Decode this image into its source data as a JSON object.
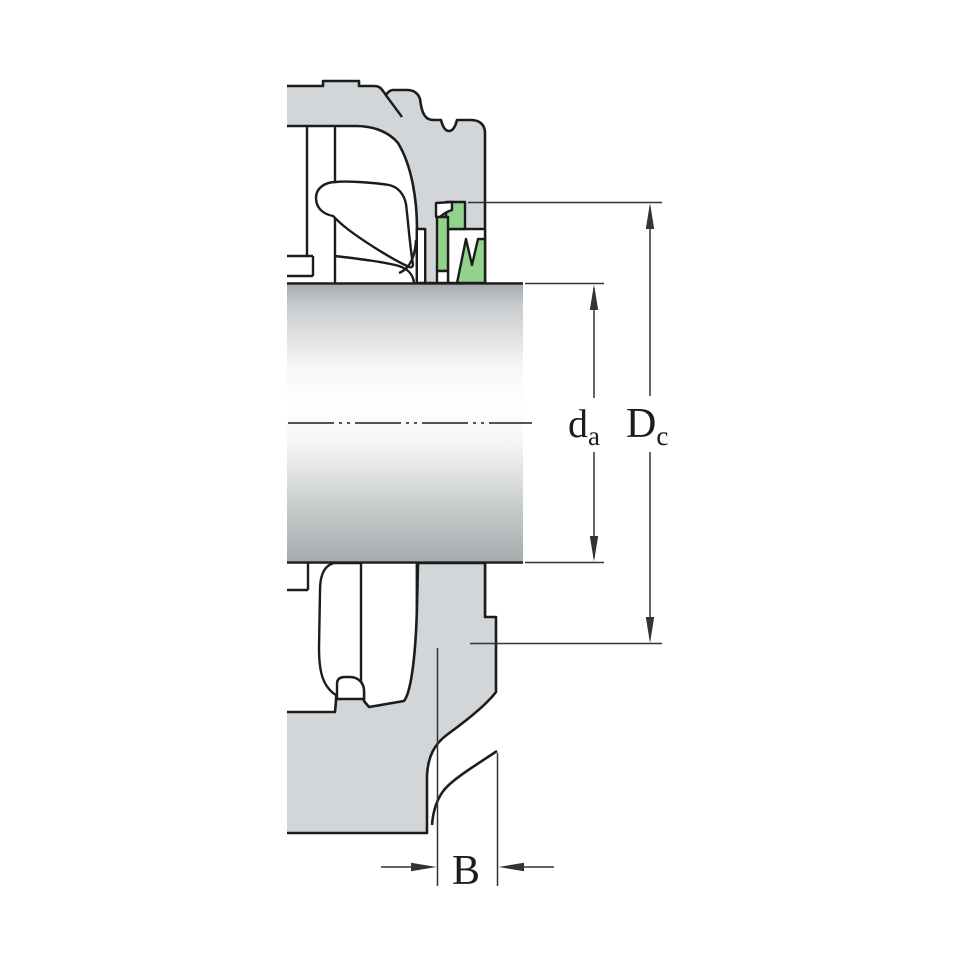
{
  "figure": {
    "kind": "bearing-unit cross-section technical drawing"
  },
  "dimensions": {
    "da": {
      "main": "d",
      "sub": "a"
    },
    "Dc": {
      "main": "D",
      "sub": "c"
    },
    "B": {
      "label": "B"
    }
  },
  "colors": {
    "housing_gray": "#d3d6d8",
    "seal_green": "#92d28c",
    "outline": "#1c1c1c",
    "dim_line": "#333333",
    "background": "#ffffff"
  }
}
